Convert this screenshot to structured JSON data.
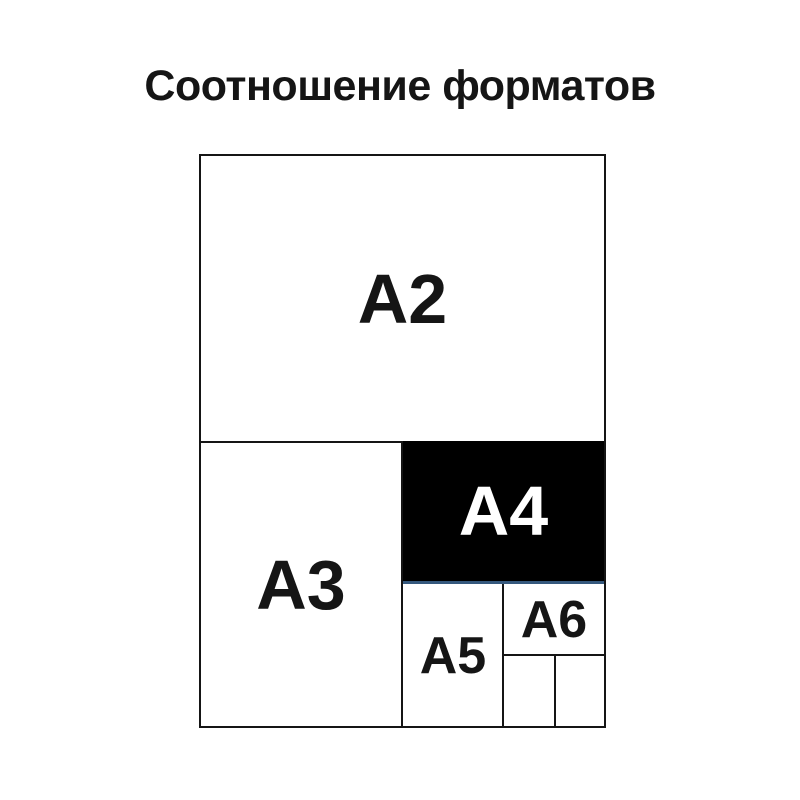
{
  "title": "Соотношение форматов",
  "diagram": {
    "formats": [
      {
        "id": "a2",
        "label": "A2"
      },
      {
        "id": "a3",
        "label": "A3"
      },
      {
        "id": "a4",
        "label": "A4"
      },
      {
        "id": "a5",
        "label": "A5"
      },
      {
        "id": "a6",
        "label": "A6"
      }
    ],
    "unlabeled_subcells_count": 2,
    "colors": {
      "background": "#ffffff",
      "line": "#151515",
      "a4_fill": "#000000",
      "a4_label": "#ffffff",
      "a4_accent_underline": "#35587d",
      "title_text": "#151515"
    }
  }
}
